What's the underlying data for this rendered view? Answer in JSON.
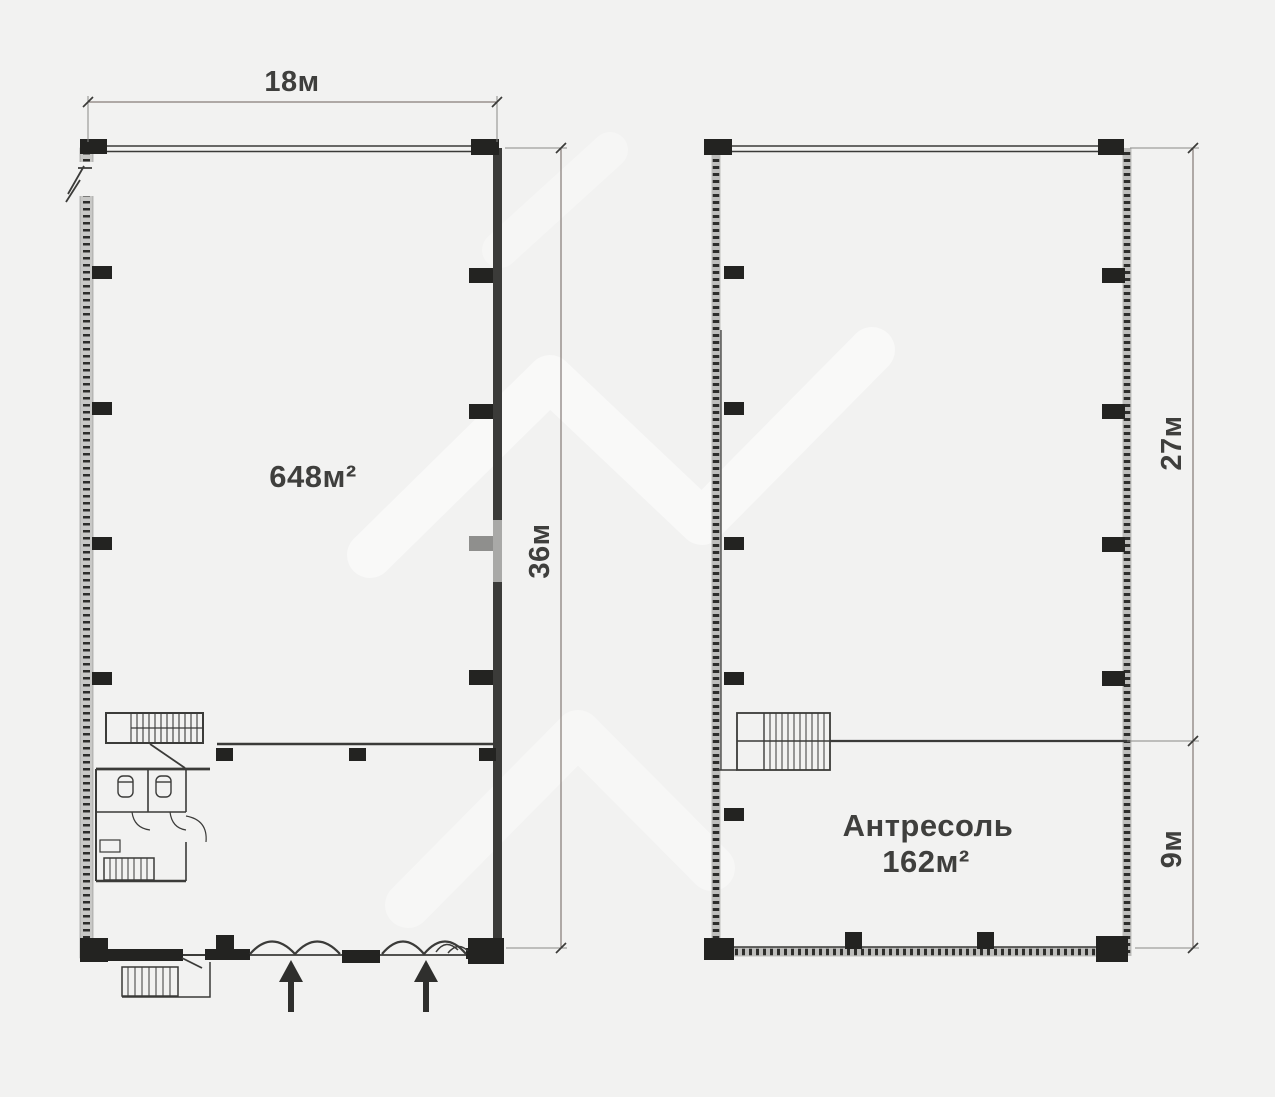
{
  "drawing": {
    "background": "#f2f2f1",
    "ink": "#3b3b39",
    "column_color": "#232321",
    "dimension_line_color": "#6c605b",
    "watermark_color": "#ffffff"
  },
  "first_floor": {
    "area_label": "648м²",
    "width_dimension": "18м",
    "depth_dimension": "36м"
  },
  "mezzanine": {
    "name_label": "Антресоль",
    "area_label": "162м²",
    "hall_depth_dimension": "27м",
    "mezzanine_depth_dimension": "9м"
  }
}
